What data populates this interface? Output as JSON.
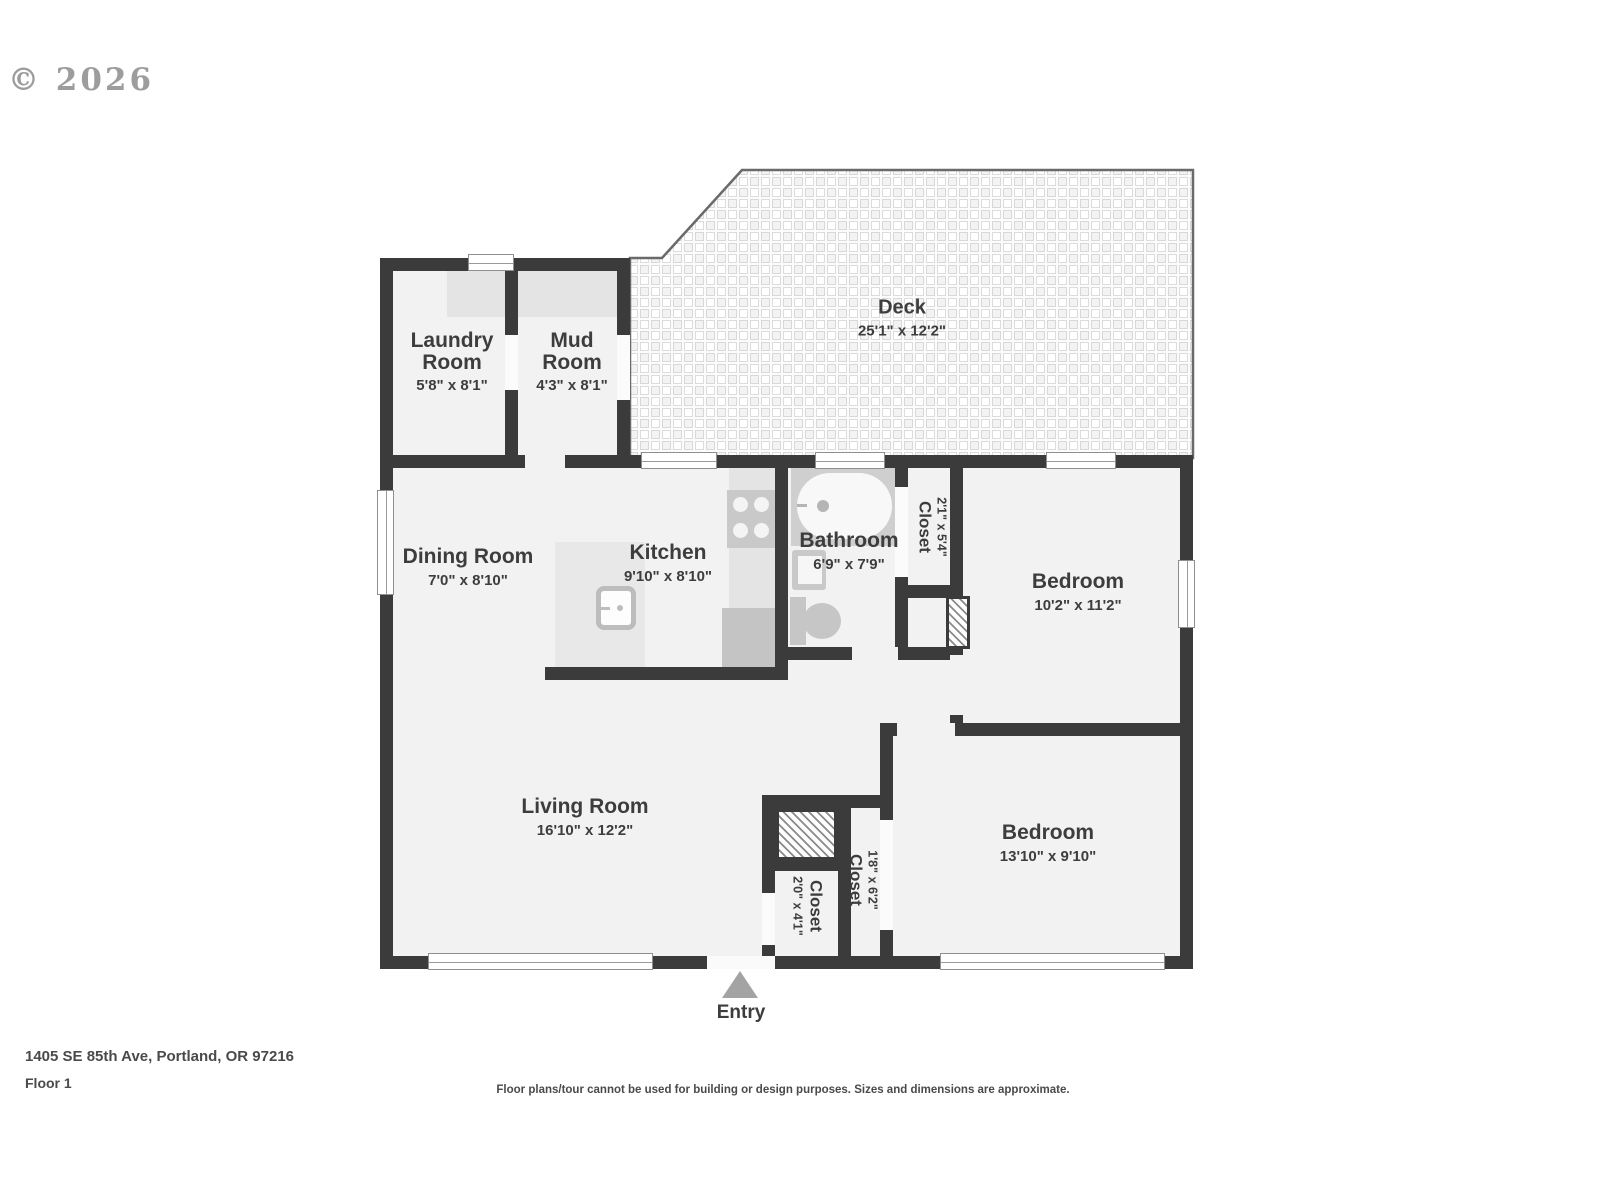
{
  "watermark": "© 2026",
  "entry_label": "Entry",
  "rooms": {
    "laundry": {
      "name": "Laundry Room",
      "dims": "5'8\" x 8'1\""
    },
    "mud": {
      "name": "Mud Room",
      "dims": "4'3\" x 8'1\""
    },
    "deck": {
      "name": "Deck",
      "dims": "25'1\" x 12'2\""
    },
    "dining": {
      "name": "Dining Room",
      "dims": "7'0\" x 8'10\""
    },
    "kitchen": {
      "name": "Kitchen",
      "dims": "9'10\" x 8'10\""
    },
    "bathroom": {
      "name": "Bathroom",
      "dims": "6'9\" x 7'9\""
    },
    "closet_bathroom": {
      "name": "Closet",
      "dims": "2'1\" x 5'4\""
    },
    "bedroom_upper": {
      "name": "Bedroom",
      "dims": "10'2\" x 11'2\""
    },
    "living": {
      "name": "Living Room",
      "dims": "16'10\" x 12'2\""
    },
    "closet_entry": {
      "name": "Closet",
      "dims": "2'0\" x 4'1\""
    },
    "closet_bedroom": {
      "name": "Closet",
      "dims": "1'8\" x 6'2\""
    },
    "bedroom_lower": {
      "name": "Bedroom",
      "dims": "13'10\" x 9'10\""
    }
  },
  "footer": {
    "address": "1405 SE 85th Ave, Portland, OR 97216",
    "floor": "Floor 1",
    "disclaimer": "Floor plans/tour cannot be used for building or design purposes. Sizes and dimensions are approximate."
  },
  "colors": {
    "wall": "#3b3b3b",
    "room_fill": "#f2f2f2",
    "fixture": "#c9c9c9",
    "deck_line": "#6a6a6a",
    "label_text": "#3d3d3d"
  }
}
